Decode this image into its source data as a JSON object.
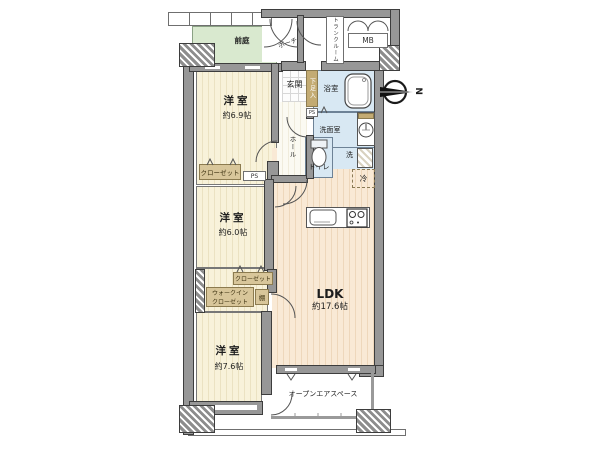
{
  "plan": {
    "compass_label": "N",
    "front_garden": "前庭",
    "porch": "ポーチ",
    "trunk_room": "トランクルーム",
    "mb": "MB",
    "entrance": "玄関",
    "shoe_box": "下足入",
    "ps_upper": "PS",
    "bath": "浴室",
    "washroom": "洗面室",
    "hall": "ホール",
    "toilet": "トイレ",
    "washer": "洗",
    "fridge": "冷",
    "bedroom1": {
      "label": "洋室",
      "size": "約6.9帖"
    },
    "closet1": "クローゼット",
    "ps_lower": "PS",
    "bedroom2": {
      "label": "洋室",
      "size": "約6.0帖"
    },
    "wic": {
      "line1": "ウォークイン",
      "line2": "クローゼット"
    },
    "closet2": "クローゼット",
    "shelf": "棚",
    "bedroom3": {
      "label": "洋室",
      "size": "約7.6帖"
    },
    "ldk": {
      "label": "LDK",
      "size": "約17.6帖"
    },
    "open_air": "オープンエアスペース"
  },
  "colors": {
    "room_floor": "#f8f2da",
    "ldk_floor": "#f9e9d5",
    "wet_area": "#d8e8f3",
    "garden": "#d9e9cf",
    "wall": "#979797",
    "label_box": "#d8c69a"
  }
}
